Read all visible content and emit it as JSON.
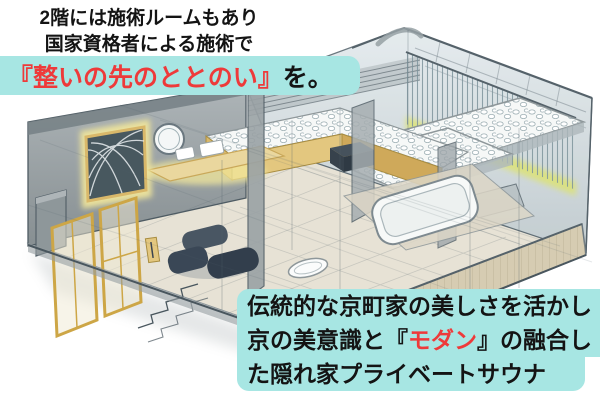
{
  "colors": {
    "highlight_bg": "#a7e6e3",
    "accent_red": "#ee3a3a",
    "text_black": "#141414",
    "bubble_white": "#ffffff"
  },
  "captions": {
    "top": {
      "line1": "2階には施術ルームもあり",
      "line2": "国家資格者による施術で",
      "highlight_red": "『整いの先のととのい』",
      "highlight_black": "を。"
    },
    "bottom": {
      "line1": "伝統的な京町家の美しさを活かし",
      "line2_pre": "京の美意識と『",
      "line2_red": "モダン",
      "line2_post": "』の融合し",
      "line3": "た隠れ家プライベートサウナ"
    }
  }
}
